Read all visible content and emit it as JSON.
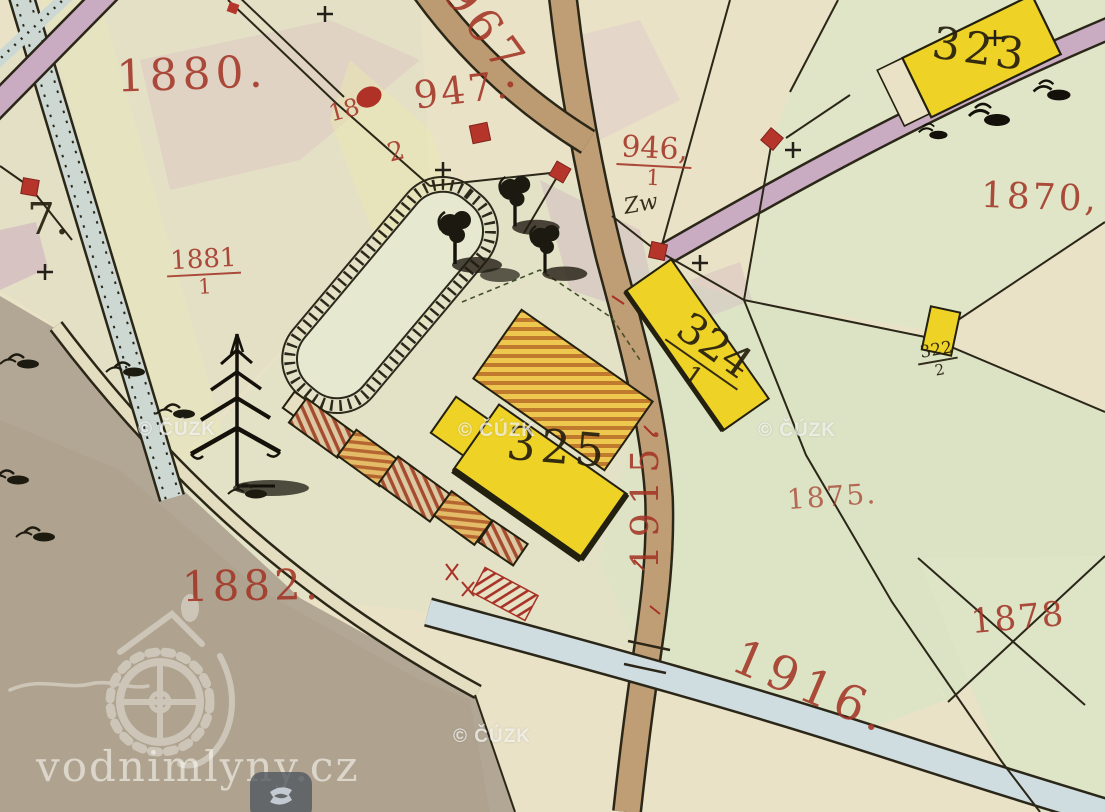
{
  "map_type": "historical cadastral map (archival, hand drawn)",
  "colors": {
    "paper": "#eae2c6",
    "meadow_green": "#dde4c6",
    "pasture_gray": "#b2a794",
    "road_tan": "#c09e75",
    "road_mauve": "#c9abc2",
    "stream_blue": "#cdd9d9",
    "building_wood_yellow": "#efd226",
    "masonry_red": "#b5352a",
    "label_red": "#a33526",
    "ink_black": "#2b2718"
  },
  "labels": {
    "p1880": "1880.",
    "p967": "967.",
    "p947": "947.",
    "p18_num": "18",
    "p18_den": "2",
    "p946_num": "946,",
    "p946_den": "1",
    "zw": "Zw",
    "b323": "323",
    "p1870": "1870,",
    "p7": "7.",
    "p1881_num": "1881",
    "p1881_den": "1",
    "b324_num": "324",
    "b324_den": "1",
    "b322_num": "322",
    "b322_den": "2",
    "b325": "325",
    "p1915": "1915.",
    "p1875": "1875.",
    "p1882": "1882.",
    "p1878": "1878",
    "p1916": "1916."
  },
  "watermarks": {
    "copyright": "© ČÚZK",
    "site": "vodnimlyny.cz"
  }
}
